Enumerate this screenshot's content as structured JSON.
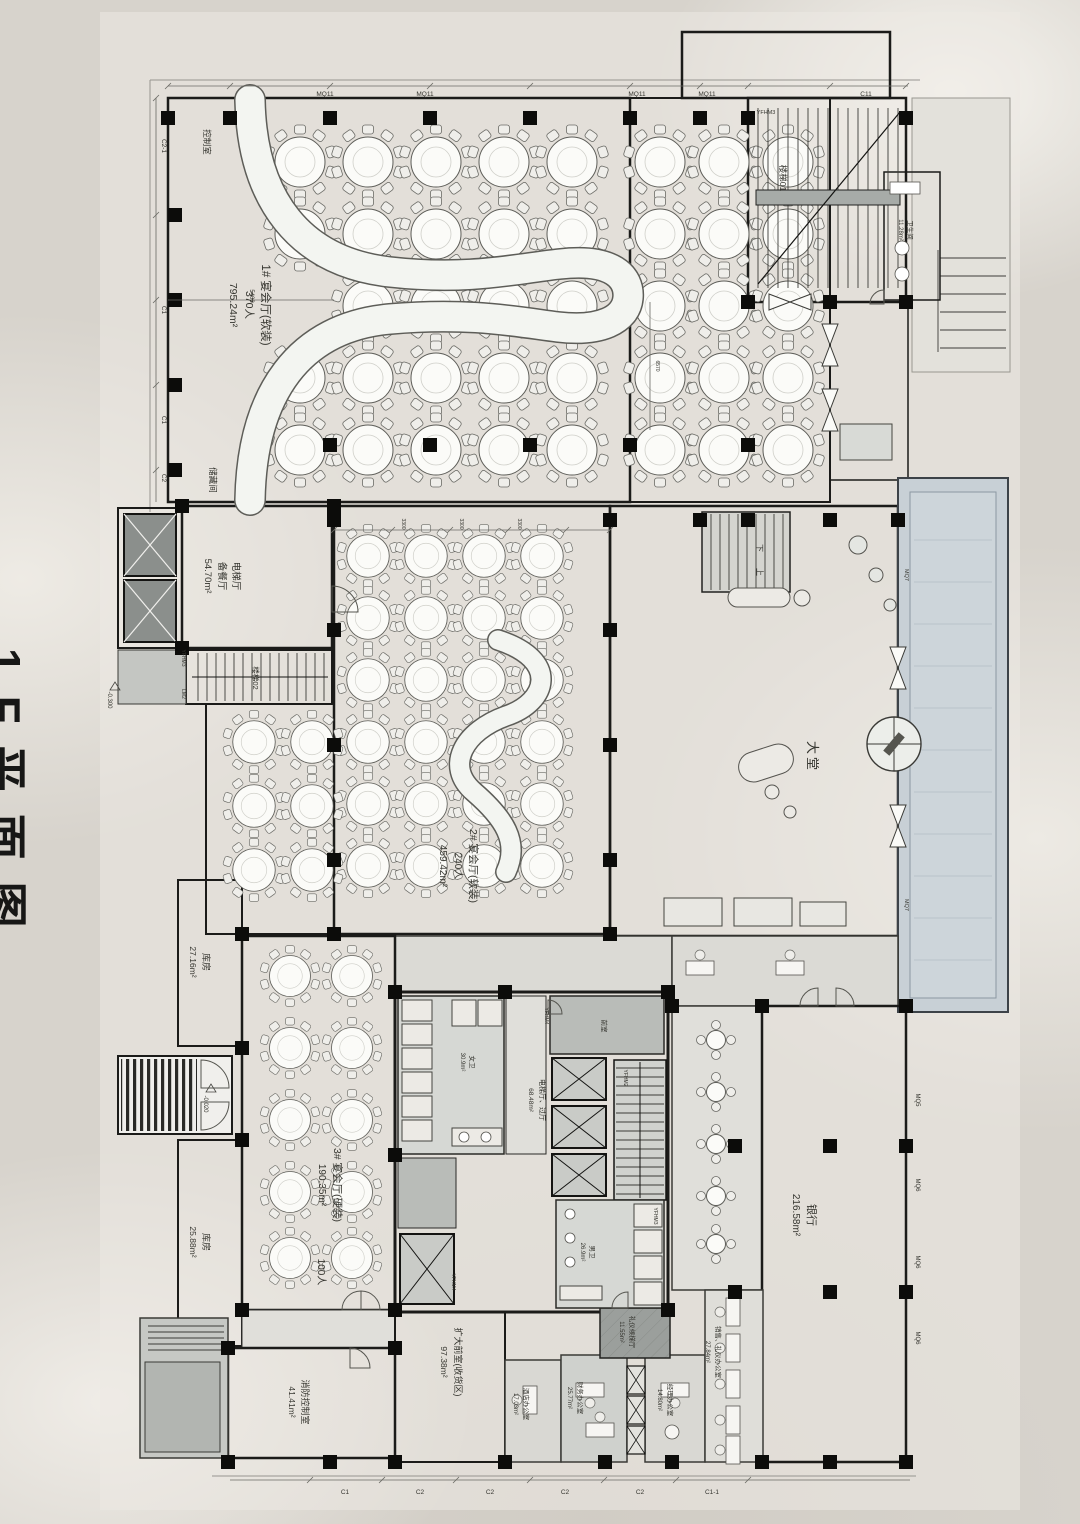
{
  "title": "1F平面图",
  "rooms": {
    "banquet1_name": "1# 宴会厅(软装)",
    "banquet1_cap": "370人",
    "banquet1_area": "795.24m²",
    "banquet2_name": "2# 宴会厅(软装)",
    "banquet2_cap": "240人",
    "banquet2_area": "459.42m²",
    "banquet3_name": "3# 宴会厅(硬装)",
    "banquet3_area": "190.35m²",
    "banquet3_cap": "100人",
    "pantry_l1": "电梯厅",
    "pantry_l2": "备餐厅",
    "pantry_area": "54.70m²",
    "control": "控制室",
    "storage": "储藏间",
    "store1_name": "库房",
    "store1_area": "27.16m²",
    "store2_name": "库房",
    "store2_area": "25.88m²",
    "lobby": "大堂",
    "bank_name": "银行",
    "bank_area": "216.58m²",
    "fire_name": "消防控制室",
    "fire_area": "41.41m²",
    "vest_name": "扩大前室(收货区)",
    "vest_area": "97.38m²",
    "stair01": "楼梯01",
    "stair02": "楼梯02",
    "elevhall_name": "电梯厅、过厅",
    "elevhall_area": "68.48m²",
    "womens_name": "女卫",
    "womens_area": "30.9m²",
    "mens_name": "男卫",
    "mens_area": "26.9m²",
    "front_room": "前室",
    "hotel_name": "酒店办公室",
    "hotel_area": "17.03m²",
    "finance_name": "财务办公室",
    "finance_area": "25.77m²",
    "manager_name": "经理办公室",
    "manager_area": "14.80m²",
    "sales_name": "销售、礼仪办公室",
    "sales_area": "27.84m²",
    "liftwait_name": "礼仪候梯厅",
    "liftwait_area": "11.55m²",
    "wctr_name": "卫生间",
    "wctr_area": "11.28m²",
    "stair_down": "下",
    "stair_up": "上"
  },
  "markers": {
    "mq11": "MQ11",
    "c11": "C11",
    "yfhm3": "YFHM3",
    "yfhm4": "YFHM4",
    "yfhm2": "YFHM2",
    "lm2": "LM2",
    "mq7": "MQ7",
    "mq5": "MQ5",
    "mq6": "MQ6",
    "c1": "C1",
    "c2": "C2",
    "c2_1": "C2-1",
    "c1_1": "C1-1"
  },
  "dims": {
    "d5400": "5400",
    "d3300": "3300",
    "d6570": "6570"
  },
  "elevations": {
    "e300": "-0.300",
    "e020": "-0.020"
  }
}
